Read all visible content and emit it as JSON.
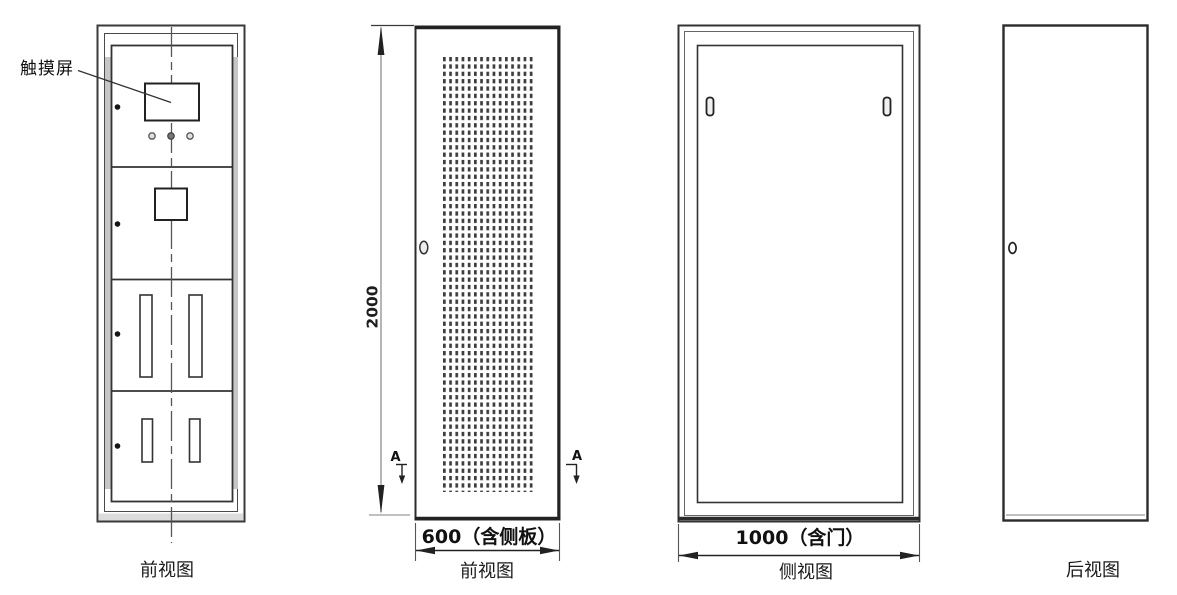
{
  "views": {
    "front_panel": {
      "name": "前视图",
      "annotation": "触摸屏"
    },
    "front_door": {
      "name": "前视图",
      "height_dim": "2000",
      "width_dim": "600（含侧板）",
      "section_marker": "A"
    },
    "side": {
      "name": "侧视图",
      "width_dim": "1000（含门）"
    },
    "rear": {
      "name": "后视图"
    }
  },
  "colors": {
    "line": "#333333",
    "dim_line": "#8f8f8f",
    "panel_grey": "#c6c6c6",
    "perforation": "#3d3d3d",
    "background": "#ffffff"
  }
}
